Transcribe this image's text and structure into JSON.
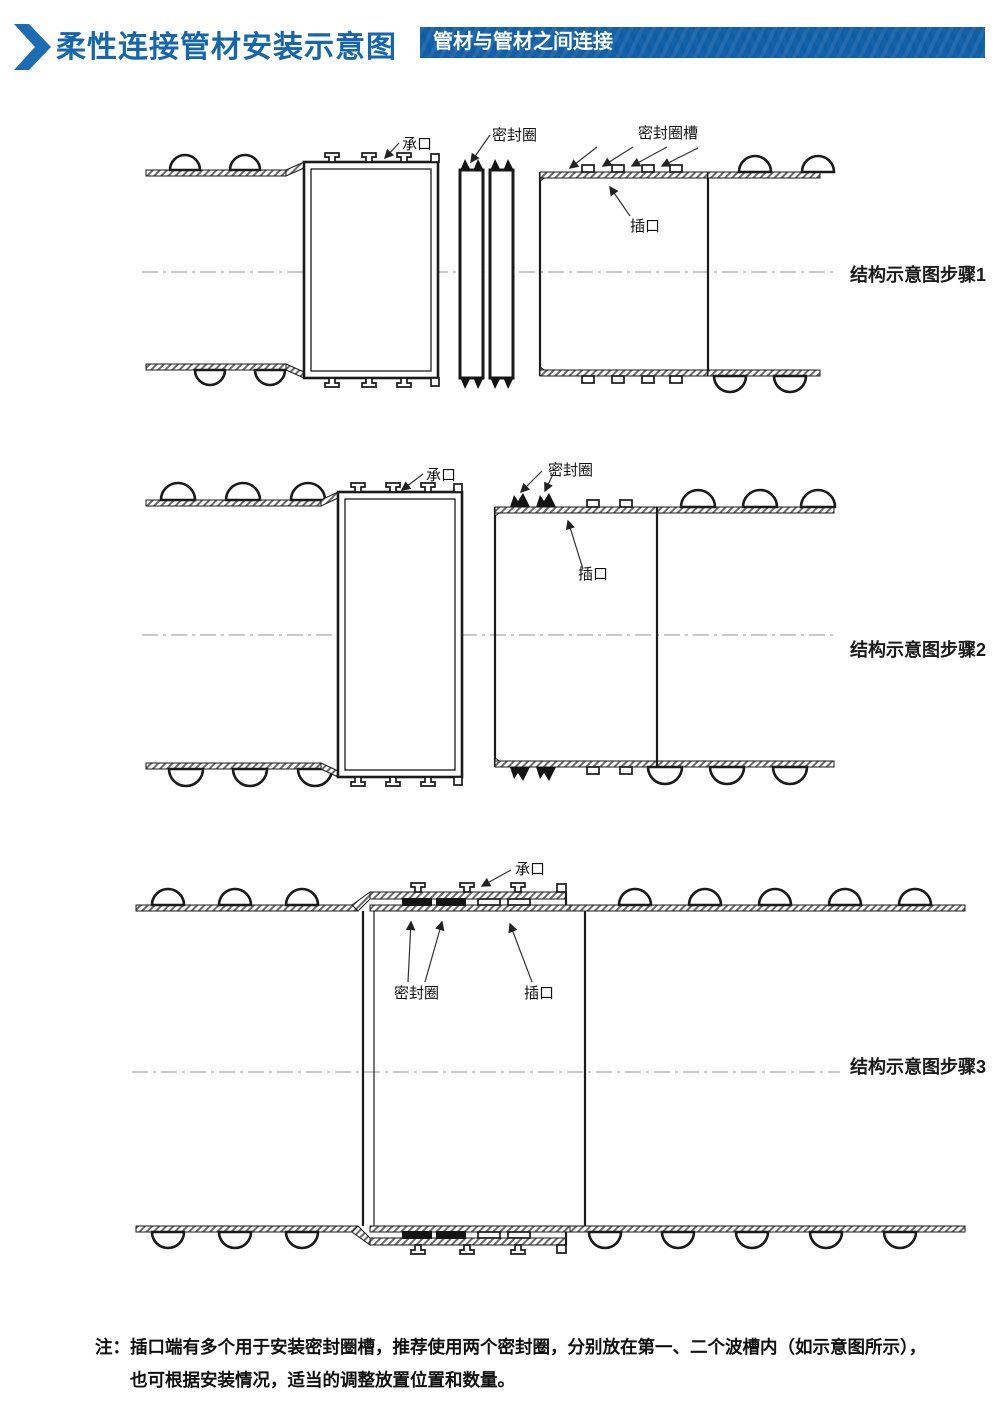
{
  "header": {
    "title": "柔性连接管材安装示意图",
    "badge": "管材与管材之间连接",
    "title_color": "#1566ac",
    "badge_bg": "#1261ab",
    "badge_text_color": "#ffffff"
  },
  "diagrams": [
    {
      "step_label": "结构示意图步骤1",
      "labels": {
        "socket": "承口",
        "seal_ring": "密封圈",
        "seal_ring_groove": "密封圈槽",
        "spigot": "插口"
      }
    },
    {
      "step_label": "结构示意图步骤2",
      "labels": {
        "socket": "承口",
        "seal_ring": "密封圈",
        "spigot": "插口"
      }
    },
    {
      "step_label": "结构示意图步骤3",
      "labels": {
        "socket": "承口",
        "seal_ring": "密封圈",
        "spigot": "插口"
      }
    }
  ],
  "note": {
    "prefix": "注：",
    "line1": "插口端有多个用于安装密封圈槽，推荐使用两个密封圈，分别放在第一、二个波槽内（如示意图所示），",
    "line2": "也可根据安装情况，适当的调整放置位置和数量。"
  },
  "drawing_colors": {
    "line": "#1a1a1a",
    "centerline": "#aaaaaa",
    "seal_fill": "#141414"
  }
}
